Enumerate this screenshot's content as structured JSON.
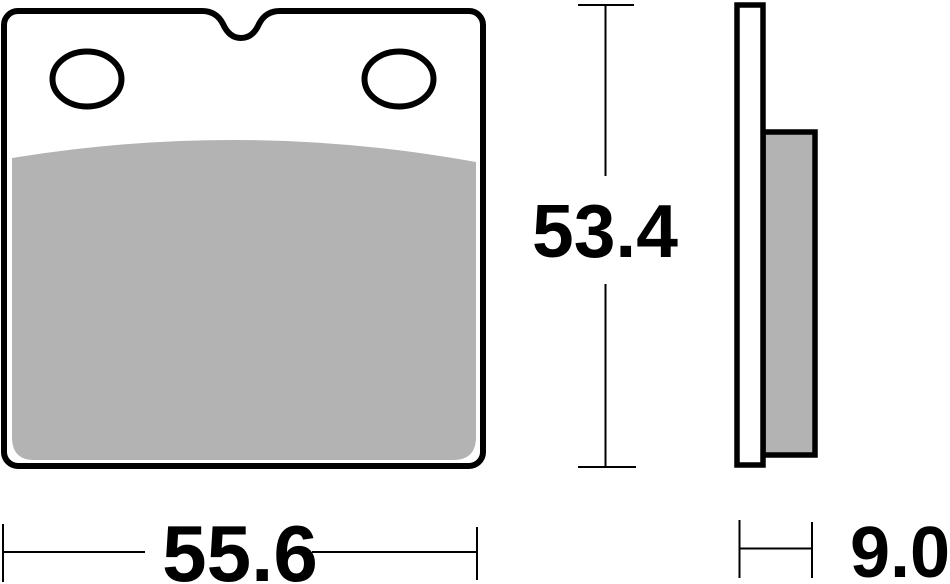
{
  "dimensions": {
    "width_label": "55.6",
    "height_label": "53.4",
    "thickness_label": "9.0"
  },
  "colors": {
    "line": "#000000",
    "friction_material": "#b3b3b3",
    "background": "#ffffff"
  }
}
